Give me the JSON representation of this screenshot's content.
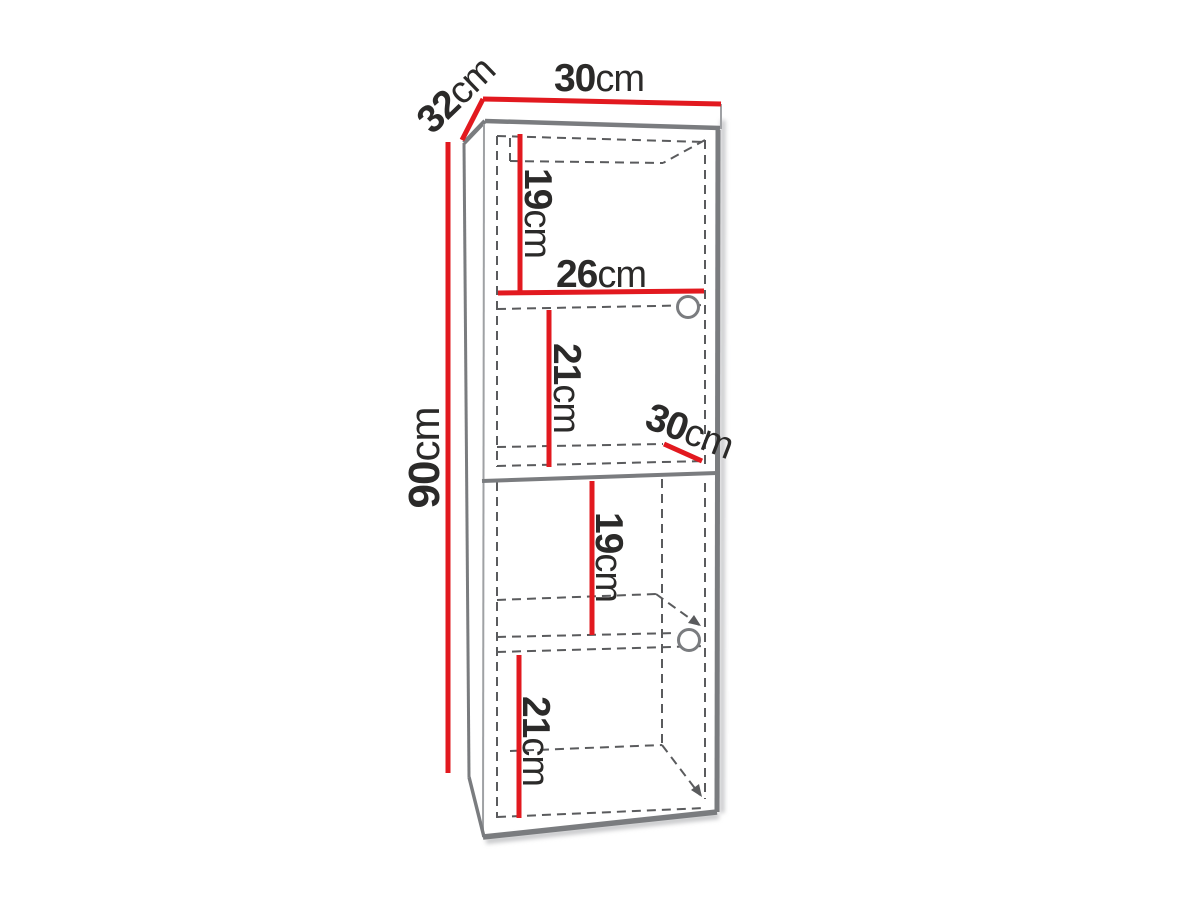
{
  "diagram": {
    "background": "#ffffff",
    "colors": {
      "dimension_red": "#e2191f",
      "outline_gray": "#7a7c7f",
      "dashed_gray": "#5a5b5d",
      "text_dark": "#2b2a29"
    },
    "labels": {
      "depth_top": {
        "value": "32",
        "unit": "cm"
      },
      "width_top": {
        "value": "30",
        "unit": "cm"
      },
      "height_total": {
        "value": "90",
        "unit": "cm"
      },
      "upper_top_section": {
        "value": "19",
        "unit": "cm"
      },
      "interior_width": {
        "value": "26",
        "unit": "cm"
      },
      "upper_bottom_section": {
        "value": "21",
        "unit": "cm"
      },
      "interior_depth": {
        "value": "30",
        "unit": "cm"
      },
      "lower_top_section": {
        "value": "19",
        "unit": "cm"
      },
      "lower_bottom_section": {
        "value": "21",
        "unit": "cm"
      }
    }
  }
}
